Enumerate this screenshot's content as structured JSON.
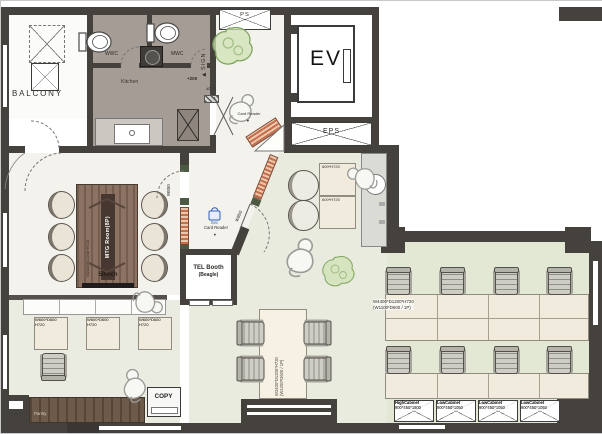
{
  "colors": {
    "wall": "#45413d",
    "wet_floor": "#a59d95",
    "office_floor": "#e2e8d3",
    "meeting_table_wood": "#8b7263",
    "pantry_wood": "#6e5a49",
    "glass_hatch_orange": "#c46f4c",
    "plant_green": "#7fa35e",
    "sec_blue": "#2f5fbf"
  },
  "rooms": {
    "balcony": "BALCONY",
    "wwc": "WWC",
    "mwc": "MWC",
    "kitchen": "Kitchen",
    "ps": "PS",
    "sign": "SIGN",
    "ev": "EV",
    "eps": "EPS",
    "mtg_room": "MTG Room(8P)",
    "tel_booth": "TEL Booth",
    "tel_booth_sub": "(Beagle)",
    "pantry": "Pantry",
    "copy": "COPY"
  },
  "labels": {
    "display": "50inch",
    "mtg_table_dim": "W2400*D1200*H720",
    "door_width": "W850",
    "level_up": "+200",
    "level_zero": "±0",
    "card_reader": "Card Reader",
    "sec": "Sec",
    "lounge_table": "600*H720",
    "island_dim": "W4400*D1200*H720",
    "island_per_seat": "(W1100*D600 / 1P)",
    "center_table_dim": "W2400*D1200*H720",
    "center_table_per_seat": "(W1200*D600 / 1P)",
    "small_desk": "W600*D600",
    "small_desk_h": "H720",
    "arrow_down": "▼",
    "arrow_left": "◀"
  },
  "cabinets": [
    {
      "name": "HighCabinet",
      "dim": "900*450*1800"
    },
    {
      "name": "LowCabinet",
      "dim": "900*450*1050"
    },
    {
      "name": "LowCabinet",
      "dim": "900*450*1050"
    },
    {
      "name": "LowCabinet",
      "dim": "900*450*1050"
    }
  ]
}
